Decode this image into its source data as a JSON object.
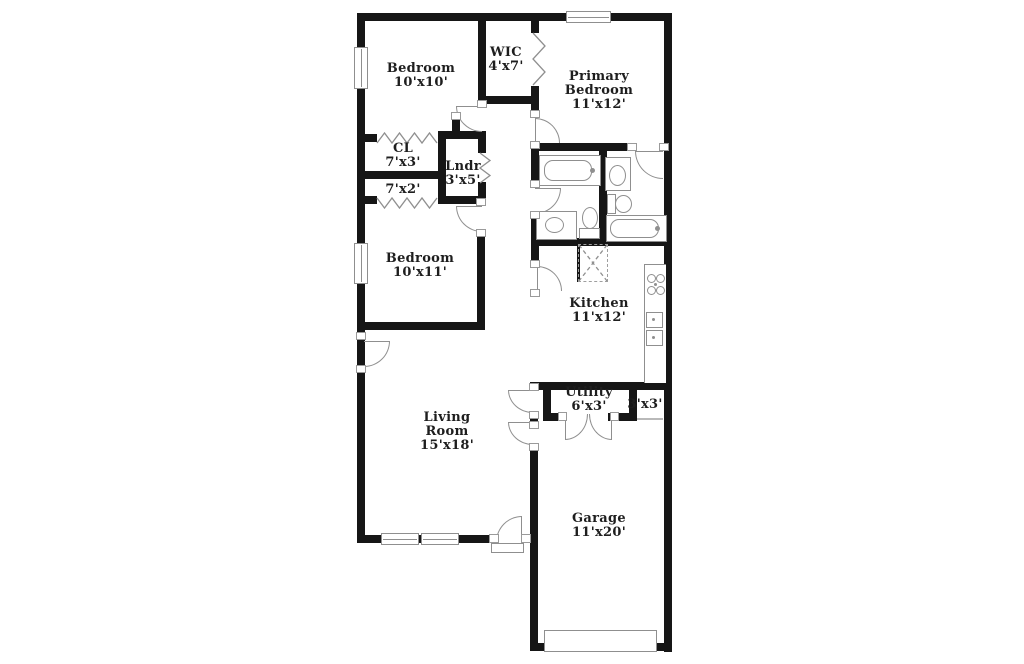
{
  "plan": {
    "canvas": {
      "width": 1024,
      "height": 664
    },
    "colors": {
      "wall": "#161616",
      "line": "#8f8f8f",
      "text": "#1e1e1e",
      "background": "#ffffff"
    },
    "rooms": [
      {
        "id": "bedroom-10x10",
        "lines": [
          "Bedroom",
          "10'x10'"
        ],
        "x": 421,
        "y": 76
      },
      {
        "id": "wic",
        "lines": [
          "WIC",
          "4'x7'"
        ],
        "x": 506,
        "y": 60
      },
      {
        "id": "primary-bedroom",
        "lines": [
          "Primary",
          "Bedroom",
          "11'x12'"
        ],
        "x": 599,
        "y": 91
      },
      {
        "id": "closet-cl",
        "lines": [
          "CL",
          "7'x3'"
        ],
        "x": 403,
        "y": 156
      },
      {
        "id": "laundry",
        "lines": [
          "Lndr",
          "3'x5'"
        ],
        "x": 463,
        "y": 174
      },
      {
        "id": "closet-7x2",
        "lines": [
          "7'x2'"
        ],
        "x": 403,
        "y": 190
      },
      {
        "id": "bedroom-10x11",
        "lines": [
          "Bedroom",
          "10'x11'"
        ],
        "x": 420,
        "y": 266
      },
      {
        "id": "kitchen",
        "lines": [
          "Kitchen",
          "11'x12'"
        ],
        "x": 599,
        "y": 311
      },
      {
        "id": "utility",
        "lines": [
          "Utility",
          "6'x3'"
        ],
        "x": 589,
        "y": 400
      },
      {
        "id": "closet-3x3",
        "lines": [
          "3'x3'"
        ],
        "x": 645,
        "y": 405
      },
      {
        "id": "living-room",
        "lines": [
          "Living",
          "Room",
          "15'x18'"
        ],
        "x": 447,
        "y": 432
      },
      {
        "id": "garage",
        "lines": [
          "Garage",
          "11'x20'"
        ],
        "x": 599,
        "y": 526
      }
    ],
    "walls": [
      [
        357,
        13,
        315,
        8
      ],
      [
        357,
        13,
        8,
        530
      ],
      [
        664,
        13,
        8,
        639
      ],
      [
        357,
        535,
        135,
        8
      ],
      [
        530,
        643,
        142,
        8
      ],
      [
        530,
        445,
        8,
        206
      ],
      [
        478,
        13,
        8,
        95
      ],
      [
        531,
        13,
        8,
        20
      ],
      [
        531,
        86,
        8,
        32
      ],
      [
        478,
        96,
        61,
        8
      ],
      [
        531,
        143,
        104,
        8
      ],
      [
        599,
        151,
        8,
        95
      ],
      [
        531,
        238,
        141,
        8
      ],
      [
        531,
        246,
        8,
        22
      ],
      [
        357,
        134,
        20,
        8
      ],
      [
        438,
        131,
        8,
        73
      ],
      [
        357,
        171,
        89,
        8
      ],
      [
        438,
        131,
        48,
        8
      ],
      [
        357,
        196,
        20,
        8
      ],
      [
        438,
        196,
        48,
        8
      ],
      [
        478,
        139,
        8,
        14
      ],
      [
        478,
        182,
        8,
        22
      ],
      [
        452,
        120,
        8,
        19
      ],
      [
        477,
        231,
        8,
        99
      ],
      [
        357,
        322,
        128,
        8
      ],
      [
        531,
        382,
        141,
        8
      ],
      [
        530,
        382,
        8,
        9
      ],
      [
        530,
        413,
        8,
        10
      ],
      [
        543,
        390,
        8,
        31
      ],
      [
        551,
        413,
        15,
        8
      ],
      [
        608,
        413,
        29,
        8
      ],
      [
        629,
        390,
        8,
        31
      ],
      [
        531,
        151,
        8,
        36
      ],
      [
        531,
        213,
        8,
        26
      ],
      [
        577,
        244,
        3,
        38
      ]
    ],
    "windows": [
      {
        "x": 354,
        "y": 47,
        "w": 14,
        "h": 42,
        "orient": "v"
      },
      {
        "x": 354,
        "y": 243,
        "w": 14,
        "h": 41,
        "orient": "v"
      },
      {
        "x": 566,
        "y": 11,
        "w": 45,
        "h": 12,
        "orient": "h"
      },
      {
        "x": 381,
        "y": 533,
        "w": 38,
        "h": 12,
        "orient": "h"
      },
      {
        "x": 421,
        "y": 533,
        "w": 38,
        "h": 12,
        "orient": "h"
      }
    ],
    "doors": [
      {
        "x": 364,
        "y": 341,
        "w": 26,
        "h": 26,
        "corner": "br",
        "borders": [
          "top",
          "right",
          "bottom"
        ],
        "name": "front-door-arc"
      },
      {
        "x": 456,
        "y": 106,
        "w": 26,
        "h": 26,
        "corner": "bl",
        "borders": [
          "top",
          "left",
          "bottom"
        ],
        "name": "bedroom-10x10-door-arc"
      },
      {
        "x": 456,
        "y": 206,
        "w": 26,
        "h": 26,
        "corner": "bl",
        "borders": [
          "top",
          "left",
          "bottom"
        ],
        "name": "bedroom-10x11-door-arc"
      },
      {
        "x": 535,
        "y": 118,
        "w": 25,
        "h": 25,
        "corner": "tr",
        "borders": [
          "top",
          "right",
          "left"
        ],
        "name": "primary-bedroom-door-arc"
      },
      {
        "x": 535,
        "y": 188,
        "w": 26,
        "h": 26,
        "corner": "br",
        "borders": [
          "top",
          "right",
          "bottom"
        ],
        "name": "hall-bath-door-arc"
      },
      {
        "x": 635,
        "y": 151,
        "w": 28,
        "h": 28,
        "corner": "bl",
        "borders": [
          "top",
          "left",
          "bottom"
        ],
        "name": "primary-bath-door-arc"
      },
      {
        "x": 537,
        "y": 266,
        "w": 25,
        "h": 25,
        "corner": "tr",
        "borders": [
          "top",
          "right",
          "left"
        ],
        "name": "kitchen-door-arc"
      },
      {
        "x": 508,
        "y": 390,
        "w": 25,
        "h": 23,
        "corner": "bl",
        "borders": [
          "top",
          "left",
          "bottom"
        ],
        "name": "utility-door-arc"
      },
      {
        "x": 508,
        "y": 422,
        "w": 25,
        "h": 23,
        "corner": "bl",
        "borders": [
          "top",
          "left",
          "bottom"
        ],
        "name": "garage-door-arc"
      },
      {
        "x": 565,
        "y": 414,
        "w": 23,
        "h": 26,
        "corner": "br",
        "borders": [
          "left",
          "right",
          "bottom"
        ],
        "name": "utility-double-door-left-arc"
      },
      {
        "x": 589,
        "y": 414,
        "w": 23,
        "h": 26,
        "corner": "bl",
        "borders": [
          "right",
          "left",
          "bottom"
        ],
        "name": "utility-double-door-right-arc"
      },
      {
        "x": 496,
        "y": 516,
        "w": 26,
        "h": 26,
        "corner": "tl",
        "borders": [
          "right",
          "top",
          "left"
        ],
        "name": "rear-door-arc"
      }
    ],
    "jambs": [
      [
        356,
        332,
        10,
        8
      ],
      [
        356,
        365,
        10,
        8
      ],
      [
        477,
        100,
        10,
        8
      ],
      [
        451,
        112,
        10,
        8
      ],
      [
        476,
        198,
        10,
        8
      ],
      [
        476,
        229,
        10,
        8
      ],
      [
        530,
        110,
        10,
        8
      ],
      [
        530,
        141,
        10,
        8
      ],
      [
        530,
        180,
        10,
        8
      ],
      [
        530,
        211,
        10,
        8
      ],
      [
        627,
        143,
        10,
        8
      ],
      [
        659,
        143,
        10,
        8
      ],
      [
        530,
        260,
        10,
        8
      ],
      [
        530,
        289,
        10,
        8
      ],
      [
        529,
        383,
        10,
        8
      ],
      [
        529,
        411,
        10,
        8
      ],
      [
        529,
        421,
        10,
        8
      ],
      [
        529,
        443,
        10,
        8
      ],
      [
        558,
        412,
        9,
        9
      ],
      [
        610,
        412,
        9,
        9
      ],
      [
        489,
        534,
        10,
        9
      ],
      [
        521,
        534,
        10,
        9
      ]
    ],
    "fixtures": [
      {
        "type": "rect",
        "x": 539,
        "y": 155,
        "w": 62,
        "h": 31,
        "name": "bathtub"
      },
      {
        "type": "roundrect",
        "x": 544,
        "y": 160,
        "w": 48,
        "h": 21,
        "name": "bathtub-basin"
      },
      {
        "type": "dot",
        "x": 590,
        "y": 168,
        "w": 5,
        "h": 5,
        "name": "faucet"
      },
      {
        "type": "rect",
        "x": 536,
        "y": 211,
        "w": 41,
        "h": 29,
        "name": "vanity"
      },
      {
        "type": "ellipse",
        "x": 545,
        "y": 217,
        "w": 19,
        "h": 16,
        "name": "sink"
      },
      {
        "type": "ellipse",
        "x": 582,
        "y": 207,
        "w": 16,
        "h": 22,
        "name": "toilet-bowl"
      },
      {
        "type": "rect",
        "x": 579,
        "y": 228,
        "w": 21,
        "h": 11,
        "name": "toilet-tank"
      },
      {
        "type": "rect",
        "x": 605,
        "y": 157,
        "w": 26,
        "h": 34,
        "name": "vanity"
      },
      {
        "type": "ellipse",
        "x": 609,
        "y": 165,
        "w": 17,
        "h": 21,
        "name": "sink"
      },
      {
        "type": "rect",
        "x": 607,
        "y": 194,
        "w": 9,
        "h": 20,
        "name": "toilet-tank"
      },
      {
        "type": "ellipse",
        "x": 615,
        "y": 195,
        "w": 17,
        "h": 18,
        "name": "toilet-bowl"
      },
      {
        "type": "rect",
        "x": 606,
        "y": 215,
        "w": 61,
        "h": 27,
        "name": "bathtub"
      },
      {
        "type": "roundrect",
        "x": 610,
        "y": 219,
        "w": 49,
        "h": 19,
        "name": "bathtub-basin"
      },
      {
        "type": "dot",
        "x": 655,
        "y": 226,
        "w": 5,
        "h": 5,
        "name": "faucet"
      },
      {
        "type": "counter",
        "x": 644,
        "y": 264,
        "w": 22,
        "h": 119,
        "name": "kitchen-counter"
      },
      {
        "type": "circle",
        "x": 647,
        "y": 274,
        "w": 9,
        "h": 9,
        "name": "stove-burner"
      },
      {
        "type": "circle",
        "x": 656,
        "y": 274,
        "w": 9,
        "h": 9,
        "name": "stove-burner"
      },
      {
        "type": "circle",
        "x": 647,
        "y": 286,
        "w": 9,
        "h": 9,
        "name": "stove-burner"
      },
      {
        "type": "circle",
        "x": 656,
        "y": 286,
        "w": 9,
        "h": 9,
        "name": "stove-burner"
      },
      {
        "type": "dot",
        "x": 654,
        "y": 283,
        "w": 3,
        "h": 3,
        "name": "stove-dot"
      },
      {
        "type": "rect",
        "x": 646,
        "y": 312,
        "w": 17,
        "h": 16,
        "name": "kitchen-sink"
      },
      {
        "type": "rect",
        "x": 646,
        "y": 330,
        "w": 17,
        "h": 16,
        "name": "kitchen-sink"
      },
      {
        "type": "dot",
        "x": 652,
        "y": 318,
        "w": 3,
        "h": 3,
        "name": "drain"
      },
      {
        "type": "dot",
        "x": 652,
        "y": 336,
        "w": 3,
        "h": 3,
        "name": "drain"
      },
      {
        "type": "dashed",
        "x": 578,
        "y": 244,
        "w": 30,
        "h": 38,
        "name": "pantry-box"
      },
      {
        "type": "rect",
        "x": 544,
        "y": 630,
        "w": 113,
        "h": 22,
        "name": "garage-door-panel"
      },
      {
        "type": "rect",
        "x": 491,
        "y": 543,
        "w": 33,
        "h": 10,
        "name": "door-threshold"
      }
    ],
    "polylines": [
      {
        "pts": "377,143 384.5,133 392,143 399.5,133 407,143 414.5,133 422,143 429.5,133 437,143",
        "dashed": false,
        "name": "bifold-cl"
      },
      {
        "pts": "377,198 384.5,208 392,198 399.5,208 407,198 414.5,208 422,198 429.5,208 437,198",
        "dashed": false,
        "name": "bifold-7x2"
      },
      {
        "pts": "480,153 490,160.5 480,168 490,175.5 480,183",
        "dashed": false,
        "name": "bifold-lndr"
      },
      {
        "pts": "533,33 545,46 533,59 545,72 533,85",
        "dashed": false,
        "name": "bifold-wic"
      },
      {
        "pts": "579,245 607,281",
        "dashed": true,
        "name": "pantry-x"
      },
      {
        "pts": "607,245 579,281",
        "dashed": true,
        "name": "pantry-x"
      },
      {
        "pts": "637,419 663,419",
        "dashed": false,
        "name": "closet-3x3-opening"
      }
    ]
  }
}
